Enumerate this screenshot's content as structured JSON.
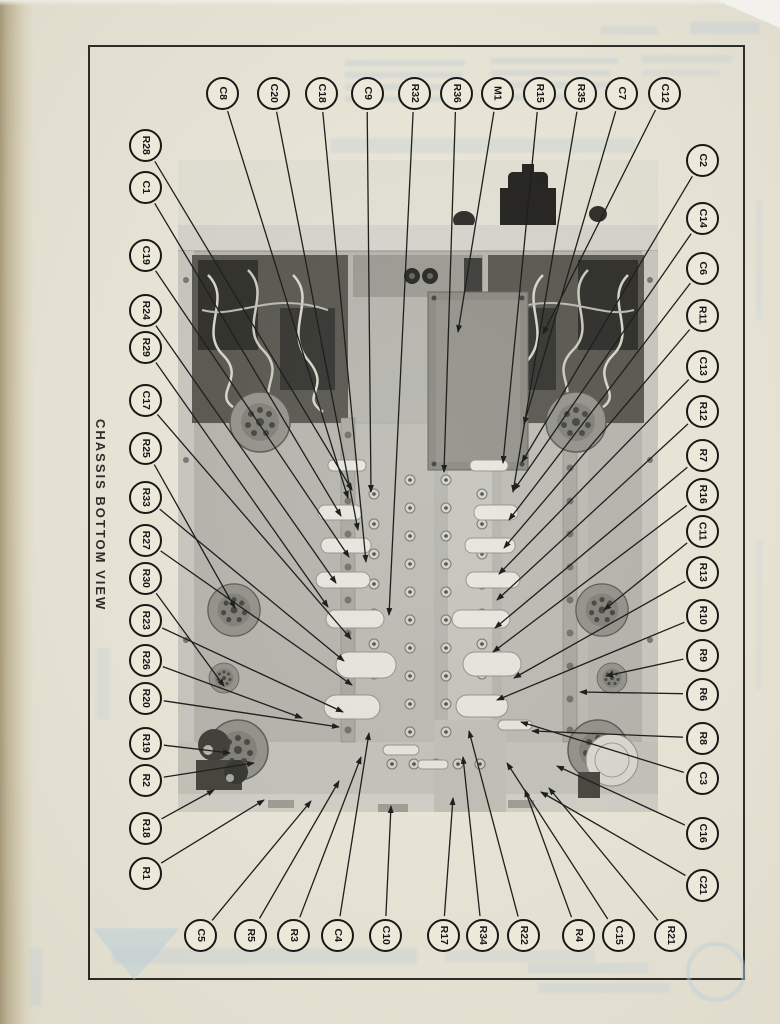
{
  "page": {
    "title": "CHASSIS BOTTOM VIEW",
    "ink_color": "#1c1c1a",
    "paper_color": "#ebe8da"
  },
  "diagram": {
    "callouts": [
      {
        "id": "C8",
        "side": "top",
        "cx": 222,
        "cy": 93,
        "tx": 348,
        "ty": 498
      },
      {
        "id": "C20",
        "side": "top",
        "cx": 273,
        "cy": 93,
        "tx": 358,
        "ty": 530
      },
      {
        "id": "C18",
        "side": "top",
        "cx": 321,
        "cy": 93,
        "tx": 366,
        "ty": 562
      },
      {
        "id": "C9",
        "side": "top",
        "cx": 367,
        "cy": 93,
        "tx": 371,
        "ty": 492
      },
      {
        "id": "R32",
        "side": "top",
        "cx": 414,
        "cy": 93,
        "tx": 389,
        "ty": 615
      },
      {
        "id": "R36",
        "side": "top",
        "cx": 456,
        "cy": 93,
        "tx": 444,
        "ty": 472
      },
      {
        "id": "M1",
        "side": "top",
        "cx": 497,
        "cy": 93,
        "tx": 458,
        "ty": 332
      },
      {
        "id": "R15",
        "side": "top",
        "cx": 539,
        "cy": 93,
        "tx": 503,
        "ty": 463
      },
      {
        "id": "R35",
        "side": "top",
        "cx": 580,
        "cy": 93,
        "tx": 513,
        "ty": 492
      },
      {
        "id": "C7",
        "side": "top",
        "cx": 621,
        "cy": 93,
        "tx": 524,
        "ty": 424
      },
      {
        "id": "C12",
        "side": "top",
        "cx": 664,
        "cy": 93,
        "tx": 543,
        "ty": 334
      },
      {
        "id": "C2",
        "side": "right",
        "cx": 702,
        "cy": 160,
        "tx": 522,
        "ty": 462
      },
      {
        "id": "C14",
        "side": "right",
        "cx": 702,
        "cy": 218,
        "tx": 514,
        "ty": 490
      },
      {
        "id": "C6",
        "side": "right",
        "cx": 702,
        "cy": 268,
        "tx": 509,
        "ty": 520
      },
      {
        "id": "R11",
        "side": "right",
        "cx": 702,
        "cy": 315,
        "tx": 504,
        "ty": 548
      },
      {
        "id": "C13",
        "side": "right",
        "cx": 702,
        "cy": 366,
        "tx": 499,
        "ty": 574
      },
      {
        "id": "R12",
        "side": "right",
        "cx": 702,
        "cy": 411,
        "tx": 497,
        "ty": 600
      },
      {
        "id": "R7",
        "side": "right",
        "cx": 702,
        "cy": 455,
        "tx": 495,
        "ty": 628
      },
      {
        "id": "R16",
        "side": "right",
        "cx": 702,
        "cy": 494,
        "tx": 493,
        "ty": 652
      },
      {
        "id": "C11",
        "side": "right",
        "cx": 702,
        "cy": 531,
        "tx": 604,
        "ty": 610
      },
      {
        "id": "R13",
        "side": "right",
        "cx": 702,
        "cy": 572,
        "tx": 514,
        "ty": 678
      },
      {
        "id": "R10",
        "side": "right",
        "cx": 702,
        "cy": 615,
        "tx": 497,
        "ty": 700
      },
      {
        "id": "R9",
        "side": "right",
        "cx": 702,
        "cy": 655,
        "tx": 606,
        "ty": 676
      },
      {
        "id": "R6",
        "side": "right",
        "cx": 702,
        "cy": 694,
        "tx": 580,
        "ty": 692
      },
      {
        "id": "R8",
        "side": "right",
        "cx": 702,
        "cy": 738,
        "tx": 532,
        "ty": 731
      },
      {
        "id": "C3",
        "side": "right",
        "cx": 702,
        "cy": 778,
        "tx": 521,
        "ty": 722
      },
      {
        "id": "C16",
        "side": "right",
        "cx": 702,
        "cy": 833,
        "tx": 557,
        "ty": 766
      },
      {
        "id": "C21",
        "side": "right",
        "cx": 702,
        "cy": 885,
        "tx": 541,
        "ty": 792
      },
      {
        "id": "R28",
        "side": "left",
        "cx": 145,
        "cy": 145,
        "tx": 352,
        "ty": 490
      },
      {
        "id": "C1",
        "side": "left",
        "cx": 145,
        "cy": 187,
        "tx": 341,
        "ty": 516
      },
      {
        "id": "C19",
        "side": "left",
        "cx": 145,
        "cy": 255,
        "tx": 349,
        "ty": 557
      },
      {
        "id": "R24",
        "side": "left",
        "cx": 145,
        "cy": 310,
        "tx": 336,
        "ty": 583
      },
      {
        "id": "R29",
        "side": "left",
        "cx": 145,
        "cy": 347,
        "tx": 328,
        "ty": 607
      },
      {
        "id": "C17",
        "side": "left",
        "cx": 145,
        "cy": 400,
        "tx": 351,
        "ty": 639
      },
      {
        "id": "R25",
        "side": "left",
        "cx": 145,
        "cy": 448,
        "tx": 235,
        "ty": 608
      },
      {
        "id": "R33",
        "side": "left",
        "cx": 145,
        "cy": 497,
        "tx": 344,
        "ty": 661
      },
      {
        "id": "R27",
        "side": "left",
        "cx": 145,
        "cy": 540,
        "tx": 352,
        "ty": 685
      },
      {
        "id": "R30",
        "side": "left",
        "cx": 145,
        "cy": 578,
        "tx": 224,
        "ty": 686
      },
      {
        "id": "R23",
        "side": "left",
        "cx": 145,
        "cy": 620,
        "tx": 343,
        "ty": 712
      },
      {
        "id": "R26",
        "side": "left",
        "cx": 145,
        "cy": 660,
        "tx": 302,
        "ty": 718
      },
      {
        "id": "R20",
        "side": "left",
        "cx": 145,
        "cy": 698,
        "tx": 339,
        "ty": 727
      },
      {
        "id": "R19",
        "side": "left",
        "cx": 145,
        "cy": 743,
        "tx": 230,
        "ty": 753
      },
      {
        "id": "R2",
        "side": "left",
        "cx": 145,
        "cy": 780,
        "tx": 254,
        "ty": 763
      },
      {
        "id": "R18",
        "side": "left",
        "cx": 145,
        "cy": 828,
        "tx": 214,
        "ty": 790
      },
      {
        "id": "R1",
        "side": "left",
        "cx": 145,
        "cy": 873,
        "tx": 264,
        "ty": 800
      },
      {
        "id": "C5",
        "side": "bottom",
        "cx": 200,
        "cy": 935,
        "tx": 311,
        "ty": 801
      },
      {
        "id": "R5",
        "side": "bottom",
        "cx": 250,
        "cy": 935,
        "tx": 339,
        "ty": 781
      },
      {
        "id": "R3",
        "side": "bottom",
        "cx": 293,
        "cy": 935,
        "tx": 361,
        "ty": 757
      },
      {
        "id": "C4",
        "side": "bottom",
        "cx": 337,
        "cy": 935,
        "tx": 369,
        "ty": 733
      },
      {
        "id": "C10",
        "side": "bottom",
        "cx": 385,
        "cy": 935,
        "tx": 391,
        "ty": 806
      },
      {
        "id": "R17",
        "side": "bottom",
        "cx": 443,
        "cy": 935,
        "tx": 453,
        "ty": 798
      },
      {
        "id": "R34",
        "side": "bottom",
        "cx": 482,
        "cy": 935,
        "tx": 463,
        "ty": 757
      },
      {
        "id": "R22",
        "side": "bottom",
        "cx": 523,
        "cy": 935,
        "tx": 469,
        "ty": 731
      },
      {
        "id": "R4",
        "side": "bottom",
        "cx": 578,
        "cy": 935,
        "tx": 525,
        "ty": 790
      },
      {
        "id": "C15",
        "side": "bottom",
        "cx": 618,
        "cy": 935,
        "tx": 507,
        "ty": 763
      },
      {
        "id": "R21",
        "side": "bottom",
        "cx": 670,
        "cy": 935,
        "tx": 549,
        "ty": 788
      }
    ]
  }
}
